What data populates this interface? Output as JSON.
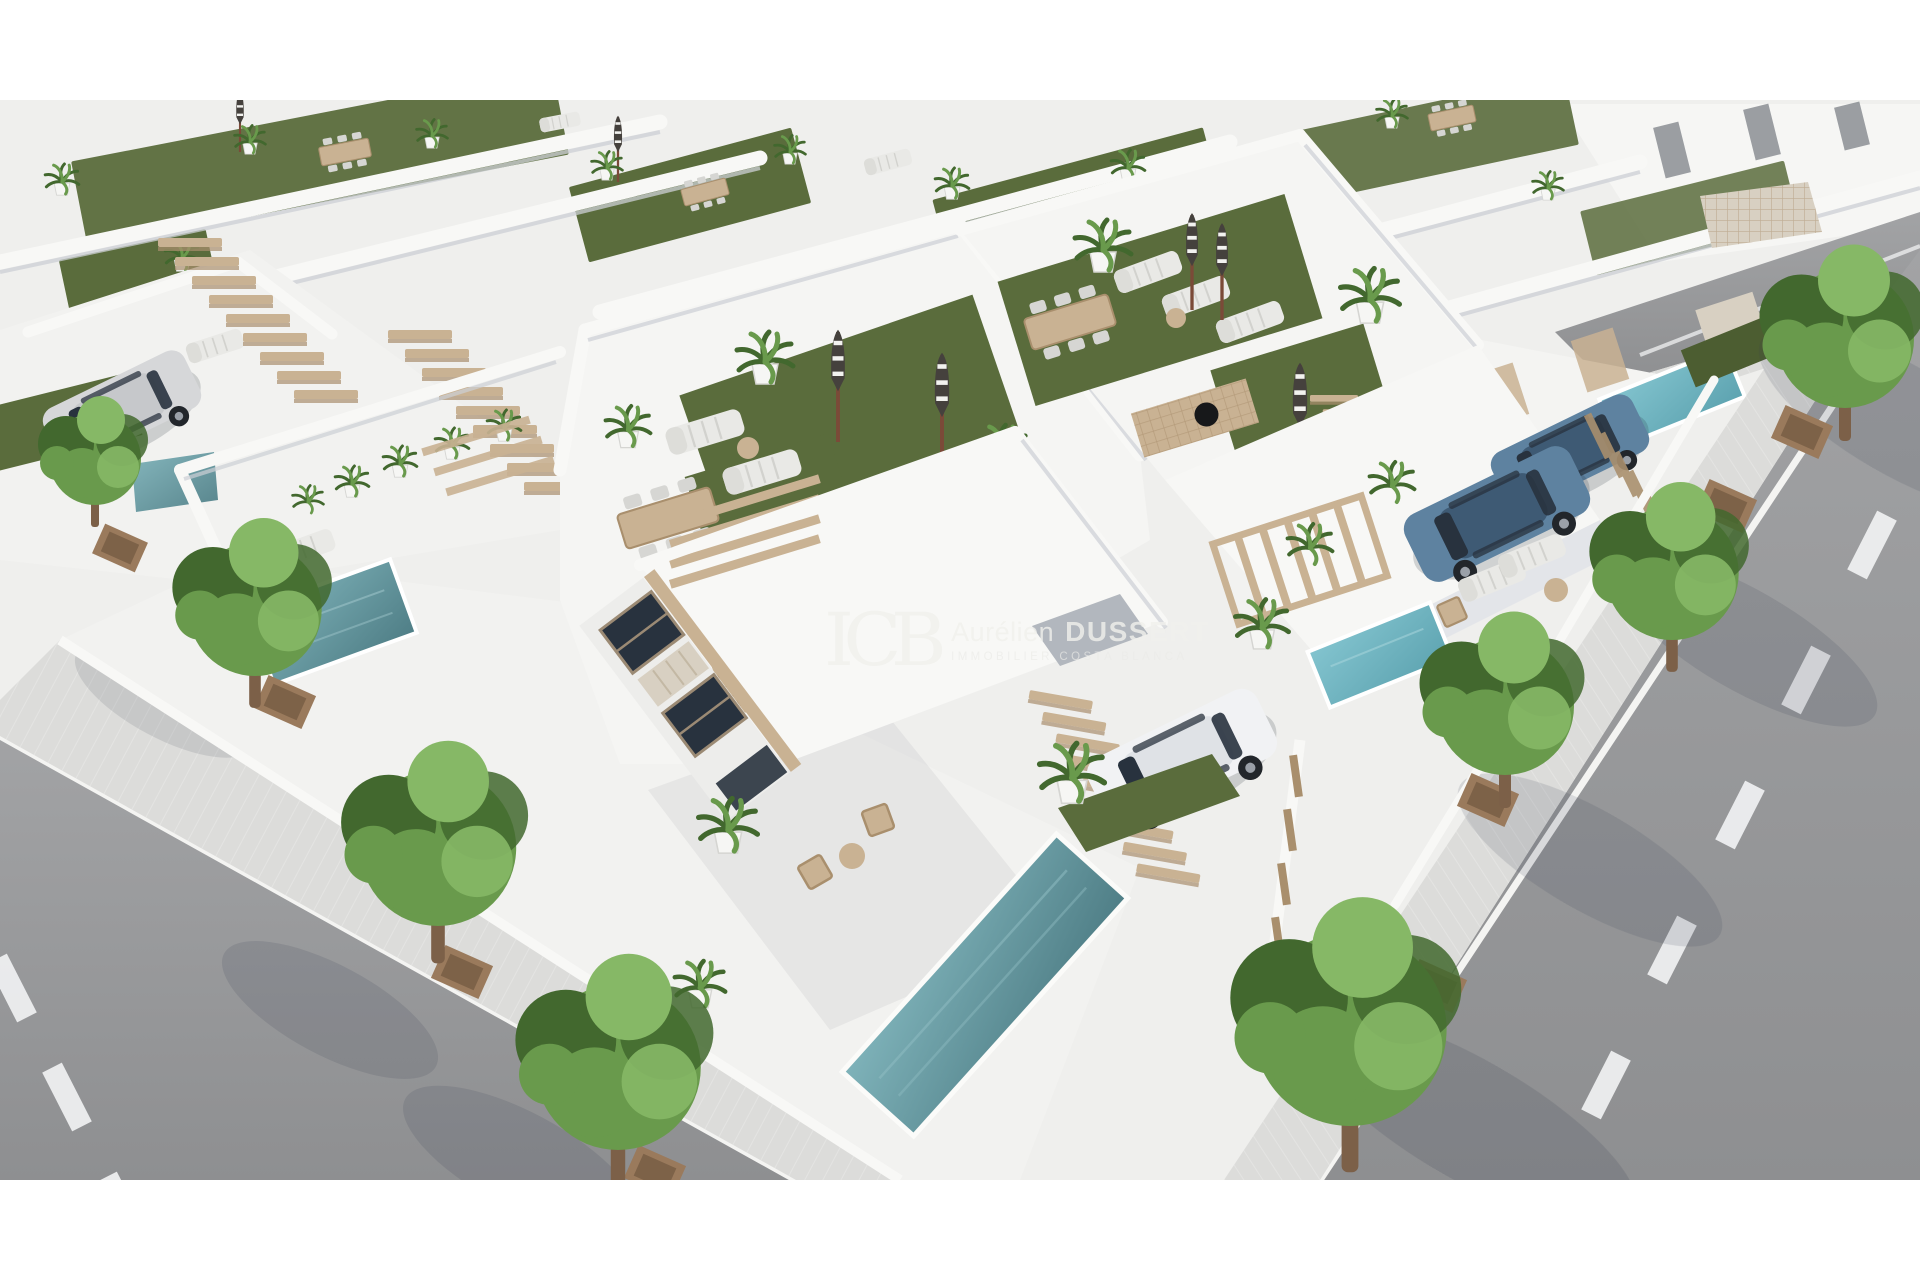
{
  "image": {
    "alt": "Aerial 3D architectural rendering of a new-build development of modern white villas with rooftop solarium terraces covered in artificial grass, sun loungers, closed parasols, potted palms, dining tables, wooden staircases, private plunge pools, parked cars in driveways and tree-lined asphalt streets"
  },
  "watermark": {
    "monogram": "ICB",
    "agent_first_name": "Aurélien",
    "agent_last_name": "DUSSERT",
    "tagline": "IMMOBILIER COSTA BLANCA"
  },
  "colors": {
    "background": "#ffffff",
    "ground": "#efefed",
    "wall_white": "#f8f8f6",
    "wall_shade": "#e3e5e9",
    "wall_dark": "#cdd0d6",
    "shadow": "#323a4c",
    "turf": "#5a6c3c",
    "turf_dark": "#4c5d31",
    "wood": "#c9b293",
    "wood_dark": "#a98f6d",
    "road": "#a2a3a5",
    "road_dark": "#8e8f91",
    "sidewalk": "#dcdcda",
    "curb": "#f4f4f2",
    "marking": "#f1f2f3",
    "pool_light": "#7fb3ba",
    "pool_deep": "#4f7e86",
    "pool_bright_light": "#83c4cf",
    "pool_bright_deep": "#5da3b0",
    "stone": "#d8d0c2",
    "tree_dark": "#42682e",
    "tree_mid": "#699a4c",
    "tree_light": "#86b866",
    "trunk": "#7c6048",
    "planter": "#9a7a5c",
    "planter_dark": "#7d6248",
    "car_white": "#f1f2f4",
    "car_white_roof": "#dfe2e6",
    "car_silver": "#d6d7d9",
    "car_silver_roof": "#c6c8cb",
    "car_blue": "#5e82a0",
    "car_blue_roof": "#3e5a74",
    "glass": "#28323e",
    "umbrella": "#45413d",
    "umbrella_pole": "#7b4a38",
    "watermark": "rgba(240,240,236,0.8)",
    "watermark_sub": "rgba(234,234,231,0.68)"
  }
}
